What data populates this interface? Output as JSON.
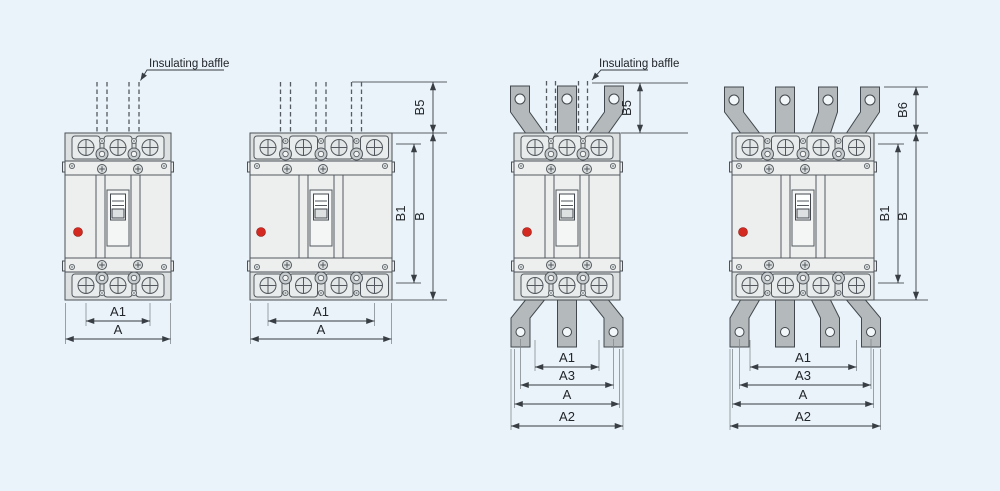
{
  "colors": {
    "background": "#e9f3f9",
    "outline": "#4c5258",
    "dimension_lines": "#383e43",
    "breaker_body": "#edefef",
    "terminal_strip": "#dce0e1",
    "terminal_tab": "#b4b9bb",
    "indicator_red": "#d42920"
  },
  "annotations": {
    "baffle_label_1": "Insulating baffle",
    "baffle_label_2": "Insulating baffle"
  },
  "drawings": {
    "d1": {
      "dims": {
        "a1": "A1",
        "a": "A"
      }
    },
    "d2": {
      "dims": {
        "b5": "B5",
        "b1": "B1",
        "b": "B",
        "a1": "A1",
        "a": "A"
      }
    },
    "d3": {
      "dims": {
        "b5": "B5",
        "a1": "A1",
        "a3": "A3",
        "a": "A",
        "a2": "A2"
      }
    },
    "d4": {
      "dims": {
        "b6": "B6",
        "b1": "B1",
        "b": "B",
        "a1": "A1",
        "a3": "A3",
        "a": "A",
        "a2": "A2"
      }
    }
  }
}
